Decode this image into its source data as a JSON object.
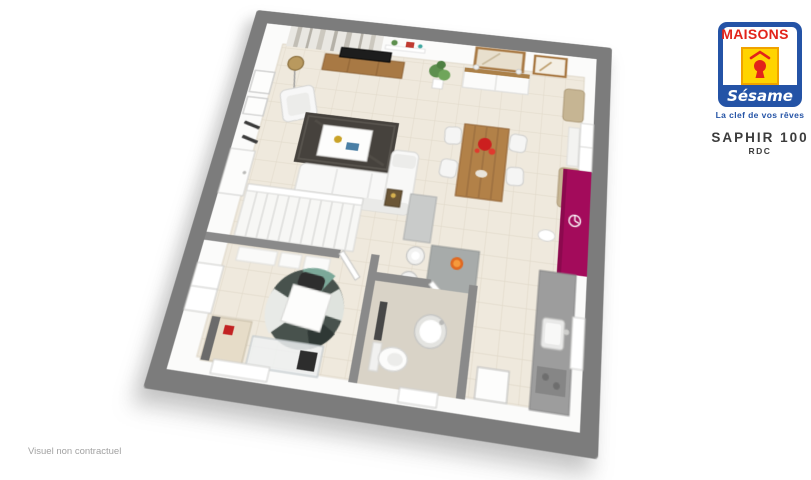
{
  "branding": {
    "brand_top": "MAISONS",
    "brand_bottom": "Sésame",
    "tagline": "La clef de vos rêves"
  },
  "plan": {
    "title": "SAPHIR 100",
    "floor_label": "RDC",
    "disclaimer": "Visuel non contractuel"
  },
  "icons": {
    "logo_keyhole": "keyhole-icon",
    "logo_roof": "roof-icon",
    "accent_wall_clock": "clock-icon"
  },
  "colors": {
    "logo_blue": "#2453a6",
    "logo_red": "#e2231a",
    "logo_yellow": "#ffd400",
    "title_dark": "#3c3c3c",
    "disclaimer_gray": "#a2a2a2",
    "slab_gray": "#7c7c7c",
    "inner_wall_gray": "#8a8a8a",
    "floor_beige": "#efe9dd",
    "tile_line": "#e2dacb",
    "accent_magenta": "#a30b5b",
    "wood": "#ab8048",
    "kitchen_gray": "#9d9d9d",
    "rug_charcoal": "#46423d"
  }
}
